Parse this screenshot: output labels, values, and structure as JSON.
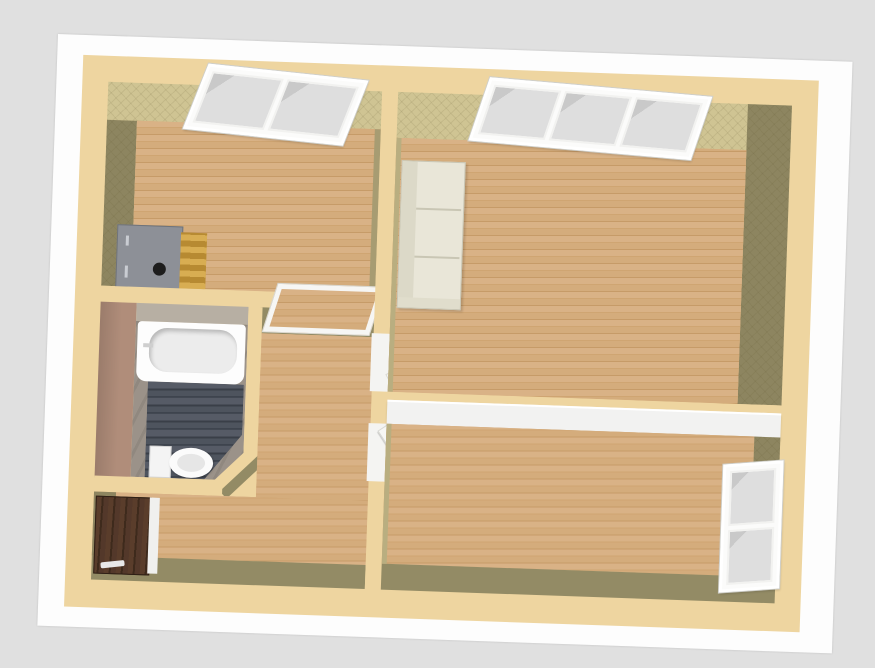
{
  "scene": {
    "type": "3d-floorplan-aerial-render",
    "visible_text": "",
    "colors": {
      "background": "#e0e0e0",
      "ground_plane": "#fdfdfd",
      "wall_top": "#eed5a0",
      "wall_face_light_khaki": "#cfc493",
      "wall_face_dark_olive": "#8d8560",
      "wall_face_olive": "#938b65",
      "wood_floor": "#d2a878",
      "bathroom_tile_floor": "#4a505a",
      "bathroom_wall_pink": "#b08d7a",
      "bathroom_wall_taupe": "#9b9289",
      "interior_door": "#f7f7f4",
      "door_handle_gold": "#e2bf1c",
      "entry_door_brown": "#503626",
      "window_frame": "#ffffff",
      "window_glass": "#d6d6d6",
      "stove_top": "#8d9097",
      "stove_side_gold": "#c79b3e",
      "sofa_cream": "#e9e6d8"
    },
    "rooms": [
      {
        "name": "room-top-left",
        "floor": "wood",
        "features": [
          "2-pane window north wall",
          "stove appliance"
        ]
      },
      {
        "name": "room-top-right",
        "floor": "wood",
        "features": [
          "3-pane window north wall",
          "cream sofa on west wall"
        ]
      },
      {
        "name": "bathroom",
        "floor": "dark slate planks",
        "features": [
          "bathtub",
          "toilet",
          "diagonal corner wall"
        ]
      },
      {
        "name": "hall-entry",
        "floor": "wood",
        "features": [
          "dark brown entry door west wall",
          "pass-through window to top-left room"
        ]
      },
      {
        "name": "room-bottom-right",
        "floor": "wood",
        "features": [
          "2-pane window east wall",
          "two open white doors with gold handles"
        ]
      }
    ]
  }
}
